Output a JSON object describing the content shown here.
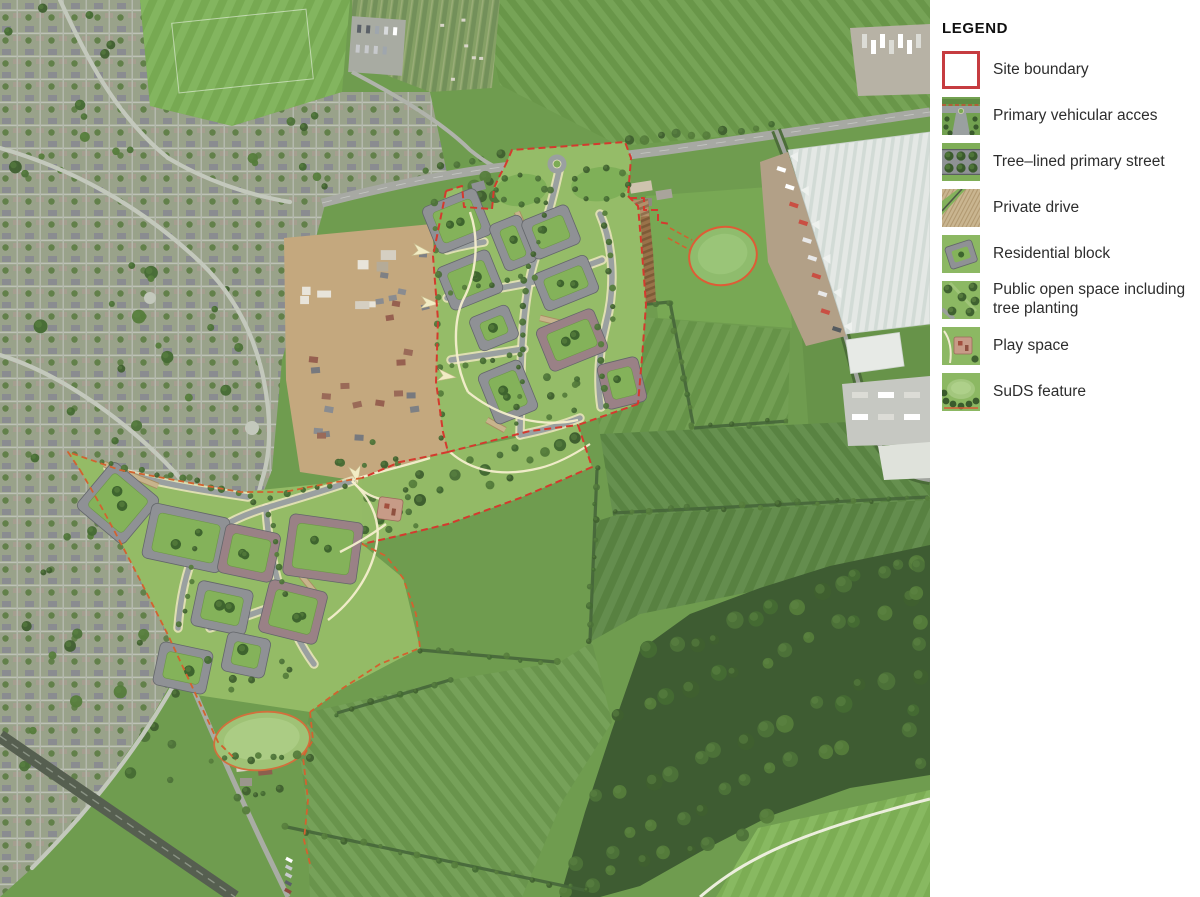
{
  "legend": {
    "title": "LEGEND",
    "items": [
      {
        "id": "site-boundary",
        "label": "Site boundary"
      },
      {
        "id": "primary-vehicular-access",
        "label": "Primary vehicular acces"
      },
      {
        "id": "tree-lined-primary-street",
        "label": "Tree–lined primary street"
      },
      {
        "id": "private-drive",
        "label": "Private drive"
      },
      {
        "id": "residential-block",
        "label": "Residential block"
      },
      {
        "id": "public-open-space",
        "label": "Public open space including tree planting"
      },
      {
        "id": "play-space",
        "label": "Play space"
      },
      {
        "id": "suds-feature",
        "label": "SuDS feature"
      }
    ]
  },
  "map": {
    "type": "aerial-illustrative-masterplan",
    "visible_features": [
      "existing suburban housing (west)",
      "large warehouse / industrial unit (north-east)",
      "housing construction site (centre-west)",
      "northern development parcel of residential blocks",
      "south-western development parcel of residential blocks",
      "primary access roundabout on the main road",
      "ploughed field inside boundary (east)",
      "SuDS ponds outlined in red/orange",
      "play space beside the south-west parcel",
      "farm fields, hedgerows and woodland (south-east)",
      "sports pitch (bottom-right corner)",
      "railway line (bottom-left)"
    ],
    "colors": {
      "site_boundary_red": "#d43a2e",
      "secondary_boundary_orange": "#d2622f",
      "open_space_green": "#94bb66",
      "courtyard_green": "#84b25a",
      "residential_ring_gray": "#8f9195",
      "residential_ring_mauve": "#9a8186",
      "private_drive_beige": "#c8b48c",
      "footpath_cream": "#f4eecd",
      "field_green": "#6f9c4f",
      "woodland_green": "#3e5c32",
      "ploughed_brown": "#997249",
      "warehouse_white": "#e4e8e5"
    }
  }
}
